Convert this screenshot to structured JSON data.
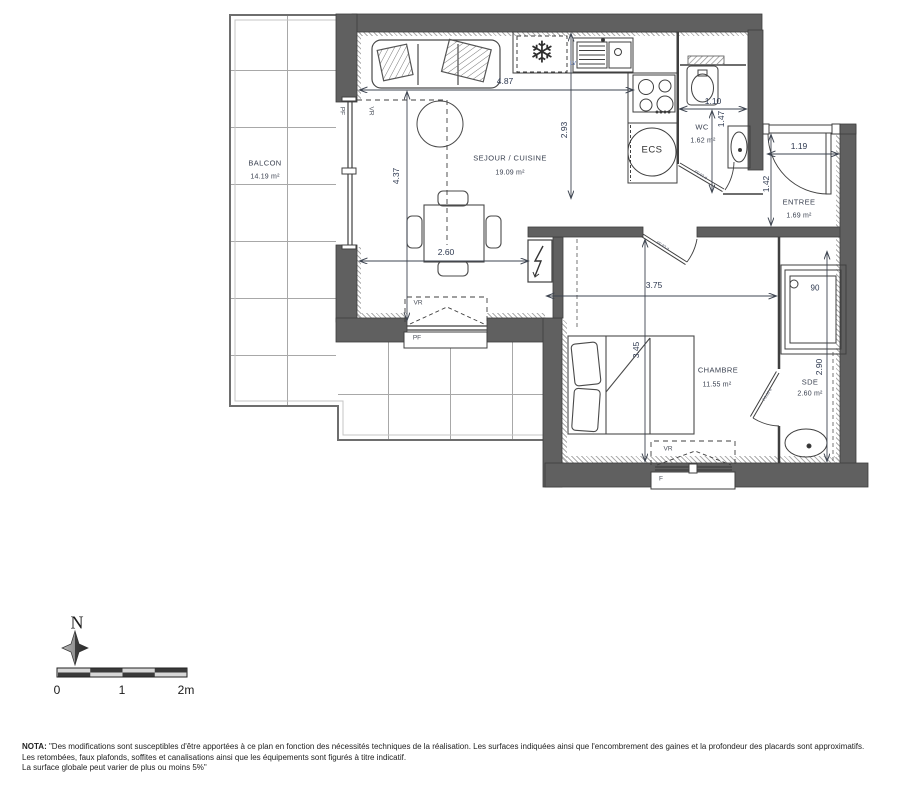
{
  "rooms": {
    "balcon": {
      "name": "BALCON",
      "area": "14.19 m²"
    },
    "sejour": {
      "name": "SEJOUR / CUISINE",
      "area": "19.09 m²"
    },
    "wc": {
      "name": "WC",
      "area": "1.62 m²"
    },
    "entree": {
      "name": "ENTREE",
      "area": "1.69 m²"
    },
    "chambre": {
      "name": "CHAMBRE",
      "area": "11.55 m²"
    },
    "sde": {
      "name": "SDE",
      "area": "2.60 m²"
    }
  },
  "dims": {
    "kitchen_w": "4.87",
    "kitchen_h": "2.93",
    "sejour_h": "4.37",
    "dining_w": "2.60",
    "chambre_w": "3.75",
    "chambre_h": "3.45",
    "sde_h": "2.90",
    "wc_w": "1.10",
    "wc_h": "1.47",
    "entree_w": "1.19",
    "entree_h": "1.42",
    "shower": "90"
  },
  "labels": {
    "ecs": "ECS",
    "lv": "LV",
    "vr": "VR",
    "pf": "PF",
    "f": "F",
    "door_wc": "P0.63 d",
    "door_chambre": "P0.83 d",
    "door_sde": "P0.63 d"
  },
  "compass": {
    "north": "N"
  },
  "scale": {
    "zero": "0",
    "one": "1",
    "two": "2m"
  },
  "nota": {
    "label": "NOTA:",
    "line1": "\"Des modifications sont susceptibles d'être apportées à ce plan en fonction des nécessités techniques de la réalisation. Les surfaces indiquées ainsi que l'encombrement des gaines et la profondeur des placards sont approximatifs.",
    "line2": "Les retombées, faux plafonds, soffites et canalisations ainsi que les équipements sont figurés à titre indicatif.",
    "line3": "La surface globale peut varier de plus ou moins 5%\""
  }
}
